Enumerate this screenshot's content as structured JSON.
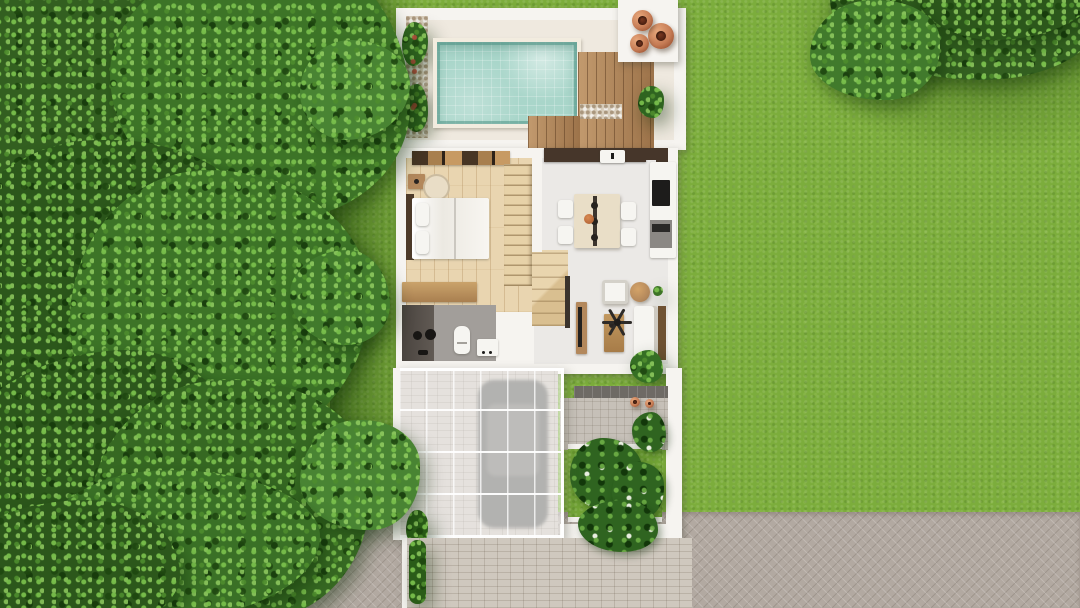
{
  "meta": {
    "view": "top-down 3d architectural floor plan render",
    "canvas": {
      "width": 1080,
      "height": 608
    },
    "visible_text": "none"
  },
  "colors": {
    "lawn": "#7cad3c",
    "grass_patch": "#74a637",
    "tree_mid": "#3d7427",
    "tree_dark": "#2c571b",
    "road": "#b2a9a1",
    "driveway": "#cfc8be",
    "wall": "#f6f4f0",
    "courtyard_floor": "#efe9df",
    "pool_water": "#a9d6ca",
    "deck_wood": "#b3875a",
    "pebble": "#d8cdbb",
    "terracotta": "#c67c55",
    "interior_wood": "#e9d5b0",
    "interior_light": "#ebe9e6",
    "counter_dark": "#46362a",
    "wood_furniture": "#b3885c",
    "dark_wood": "#4e3b29",
    "bathroom_floor": "#a29e9a",
    "shower_dark": "#57504a",
    "white_furniture": "#f6f5f1",
    "canopy": "rgba(255,255,255,0.52)",
    "car": "#5f5e5a",
    "entry_step": "#6e6a65",
    "terrace": "#c6c0b8",
    "plant_green": "#2f6420"
  },
  "scene": {
    "site": [
      "left-tree-canopy",
      "top-right-tree-canopy",
      "lawn",
      "street-pavers",
      "paver-driveway"
    ],
    "rooms": [
      {
        "name": "pool-courtyard",
        "objects": [
          "swimming-pool",
          "wood-deck",
          "pebble-strip",
          "planter-bed",
          "terracotta-pots-x3",
          "pot-platform"
        ]
      },
      {
        "name": "bedroom",
        "objects": [
          "double-bed",
          "pillows-x2",
          "headboard",
          "nightstand",
          "round-rug",
          "wardrobe",
          "dresser"
        ]
      },
      {
        "name": "staircase",
        "objects": [
          "upper-flight",
          "landing",
          "divider-wall"
        ]
      },
      {
        "name": "kitchen",
        "objects": [
          "dark-counter",
          "sink",
          "fridge",
          "cabinet"
        ]
      },
      {
        "name": "dining",
        "objects": [
          "dining-table",
          "pendant-lights",
          "chairs-x4",
          "fruit-bowl"
        ]
      },
      {
        "name": "living",
        "objects": [
          "sofa",
          "armchair",
          "coffee-table",
          "round-side-table",
          "tv-console",
          "ceiling-fan",
          "indoor-plant"
        ]
      },
      {
        "name": "bathroom",
        "objects": [
          "shower",
          "toilet",
          "vanity"
        ]
      },
      {
        "name": "carport",
        "objects": [
          "glass-pergola-canopy",
          "car",
          "paver-floor",
          "corner-plant"
        ]
      },
      {
        "name": "entry-terrace",
        "objects": [
          "entry-step",
          "paver-terrace",
          "small-pots-x2",
          "tropical-planter",
          "palm-cluster"
        ]
      }
    ]
  }
}
